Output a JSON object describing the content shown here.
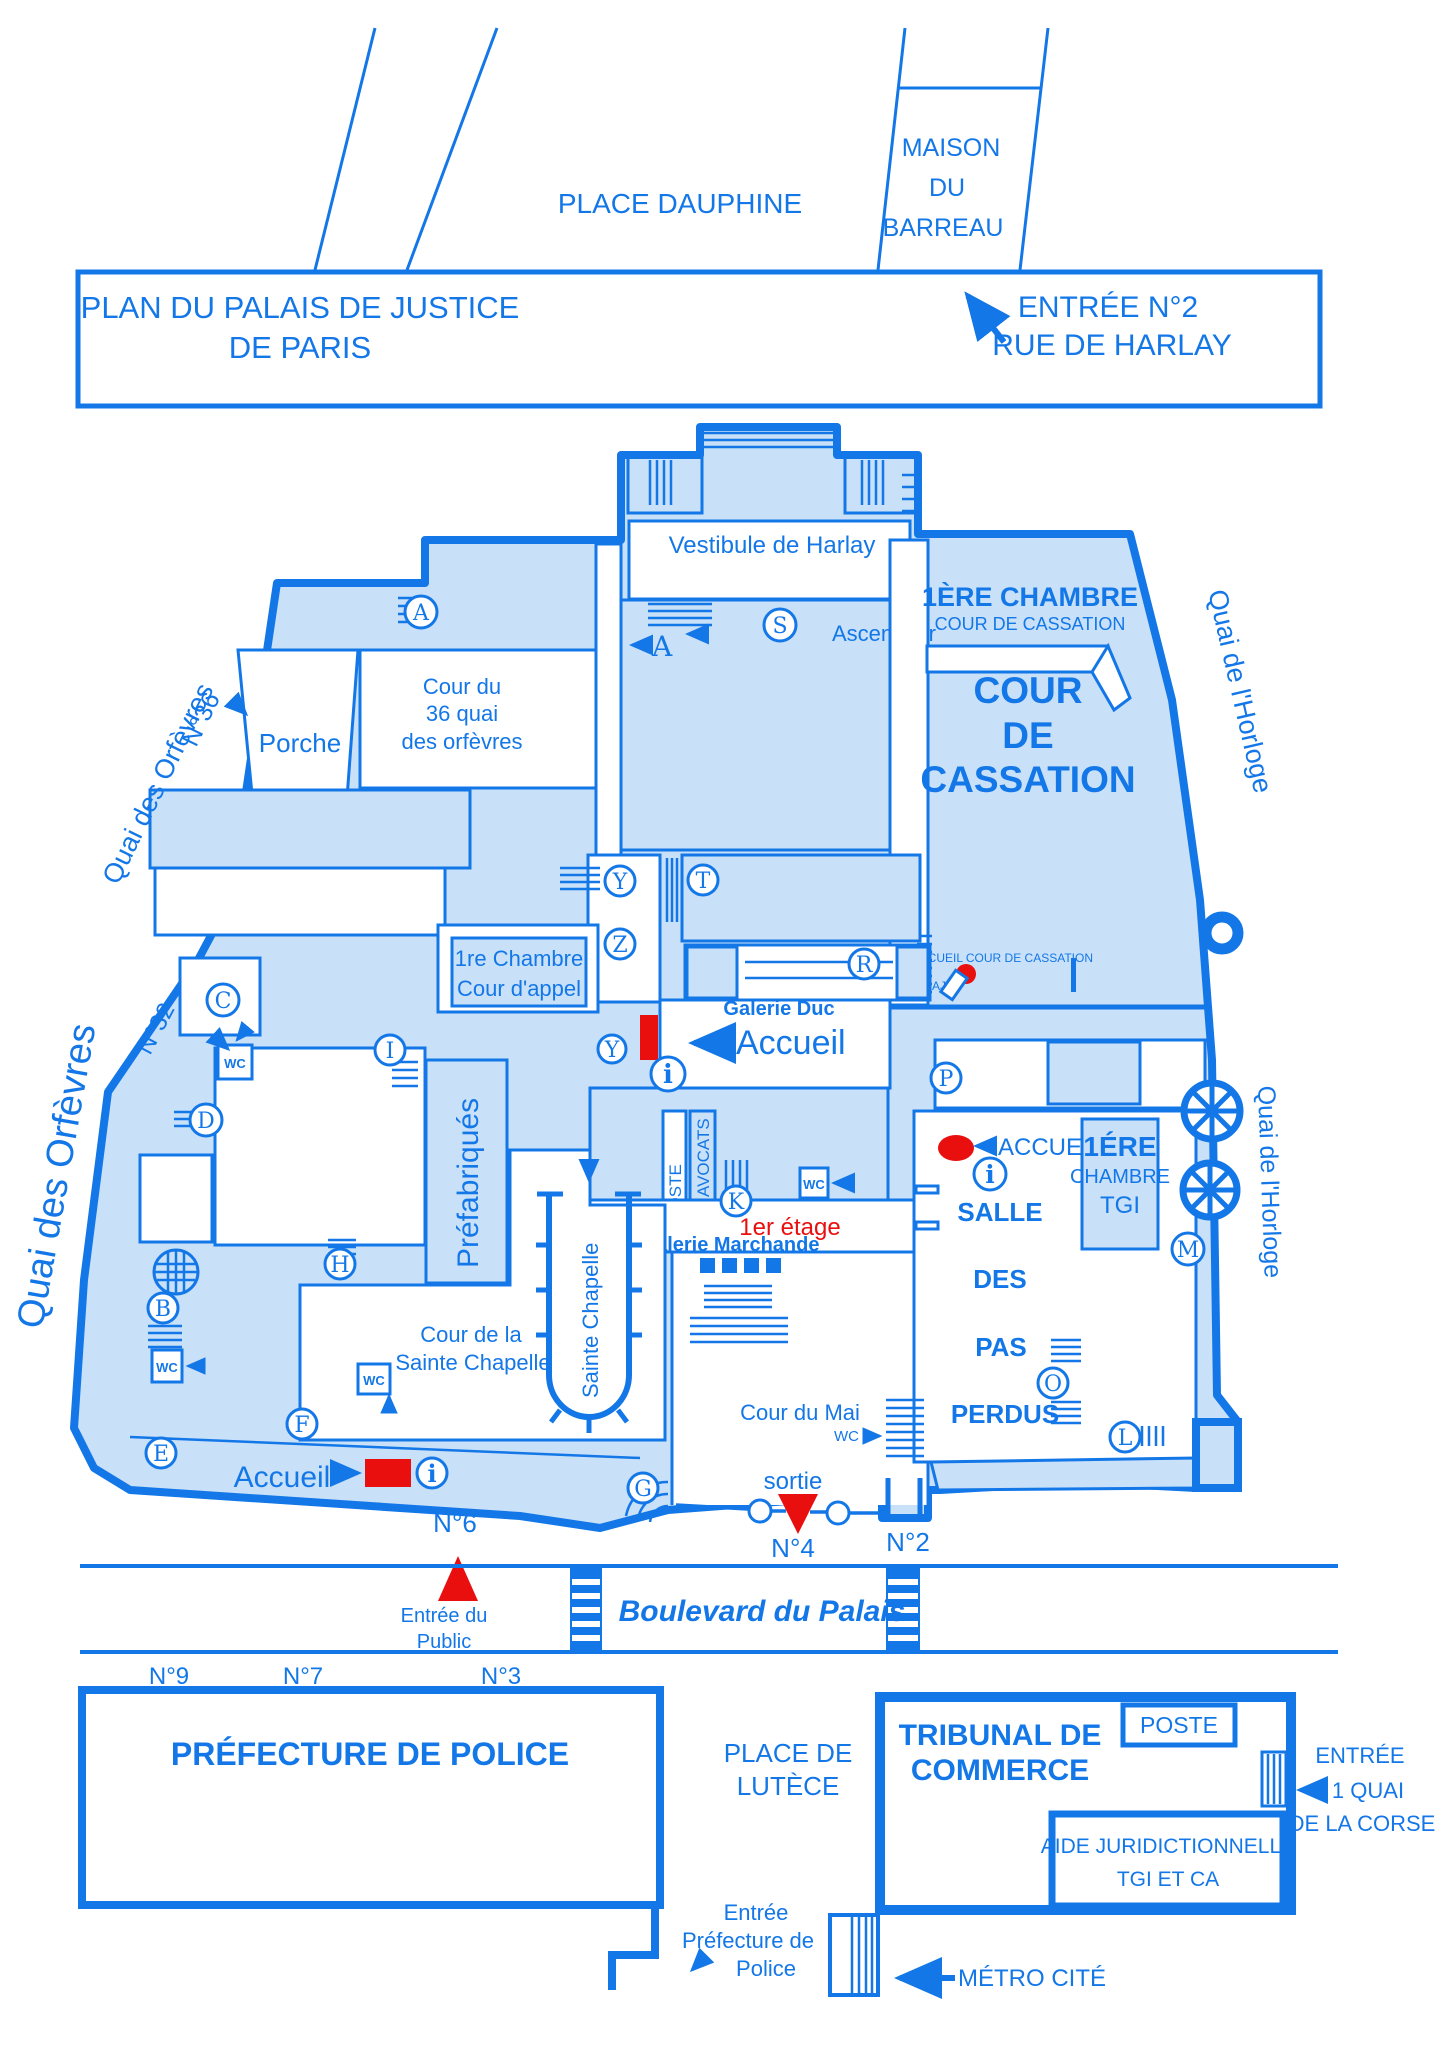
{
  "colors": {
    "blue": "#1377E8",
    "light_blue": "#C8E0F8",
    "red": "#E90F0F",
    "white": "#FFFFFF"
  },
  "title": {
    "line1": "PLAN DU PALAIS DE JUSTICE",
    "line2": "DE PARIS",
    "entrance_label": "ENTRÉE N°2",
    "entrance_street": "RUE DE HARLAY"
  },
  "top": {
    "place": "PLACE DAUPHINE",
    "maison": [
      "MAISON",
      "DU",
      "BARREAU"
    ]
  },
  "streets": {
    "quai_orfevres": "Quai des Orfèvres",
    "n36": "N°36",
    "n32": "N°32",
    "quai_horloge": "Quai de l'Horloge",
    "boulevard": "Boulevard du Palais"
  },
  "rooms": {
    "vestibule": "Vestibule de Harlay",
    "ascenseur": "Ascenseur",
    "chambre_cass1": "1ÈRE CHAMBRE",
    "chambre_cass2": "COUR DE CASSATION",
    "cour": "COUR",
    "de": "DE",
    "cassation": "CASSATION",
    "cour36_1": "Cour du",
    "cour36_2": "36 quai",
    "cour36_3": "des orfèvres",
    "porche": "Porche",
    "chambre_appel1": "1re Chambre",
    "chambre_appel2": "Cour d'appel",
    "galerie_duc": "Galerie Duc",
    "prefabriques": "Préfabriqués",
    "poste": "POSTE",
    "avocats": "AVOCATS",
    "galerie_marchande": "Galerie Marchande",
    "tgi1": "1ÉRE",
    "tgi2": "CHAMBRE",
    "tgi3": "TGI",
    "salle": "SALLE",
    "des": "DES",
    "pas": "PAS",
    "perdus": "PERDUS",
    "cour_sc1": "Cour de la",
    "cour_sc2": "Sainte Chapelle",
    "cour_mai": "Cour du Mai"
  },
  "ann": {
    "accueil": "Accueil",
    "accueil_maj": "ACCUEIL",
    "accueil_cass": "ACCUEIL COUR DE CASSATION",
    "aj": "AJ",
    "etage": "1er étage",
    "a_label": "A"
  },
  "ent": {
    "n6": "N°6",
    "n4": "N°4",
    "n2": "N°2",
    "n9": "N°9",
    "n7": "N°7",
    "n3": "N°3",
    "public1": "Entrée du",
    "public2": "Public",
    "sortie": "sortie",
    "wc": "WC"
  },
  "south": {
    "prefecture": "PRÉFECTURE DE POLICE",
    "place1": "PLACE DE",
    "place2": "LUTÈCE",
    "tribunal1": "TRIBUNAL DE",
    "tribunal2": "COMMERCE",
    "entree1": "ENTRÉE",
    "entree2": "1 QUAI",
    "entree3": "DE LA CORSE",
    "aide1": "AIDE JURIDICTIONNELLE",
    "aide2": "TGI ET CA",
    "pref1": "Entrée",
    "pref2": "Préfecture de",
    "pref3": "Police",
    "metro": "MÉTRO CITÉ"
  },
  "markers": {
    "letters": [
      "A",
      "S",
      "T",
      "Y",
      "Z",
      "R",
      "Y",
      "C",
      "I",
      "D",
      "H",
      "B",
      "E",
      "F",
      "G",
      "K",
      "P",
      "M",
      "O",
      "L"
    ],
    "info": "i"
  }
}
